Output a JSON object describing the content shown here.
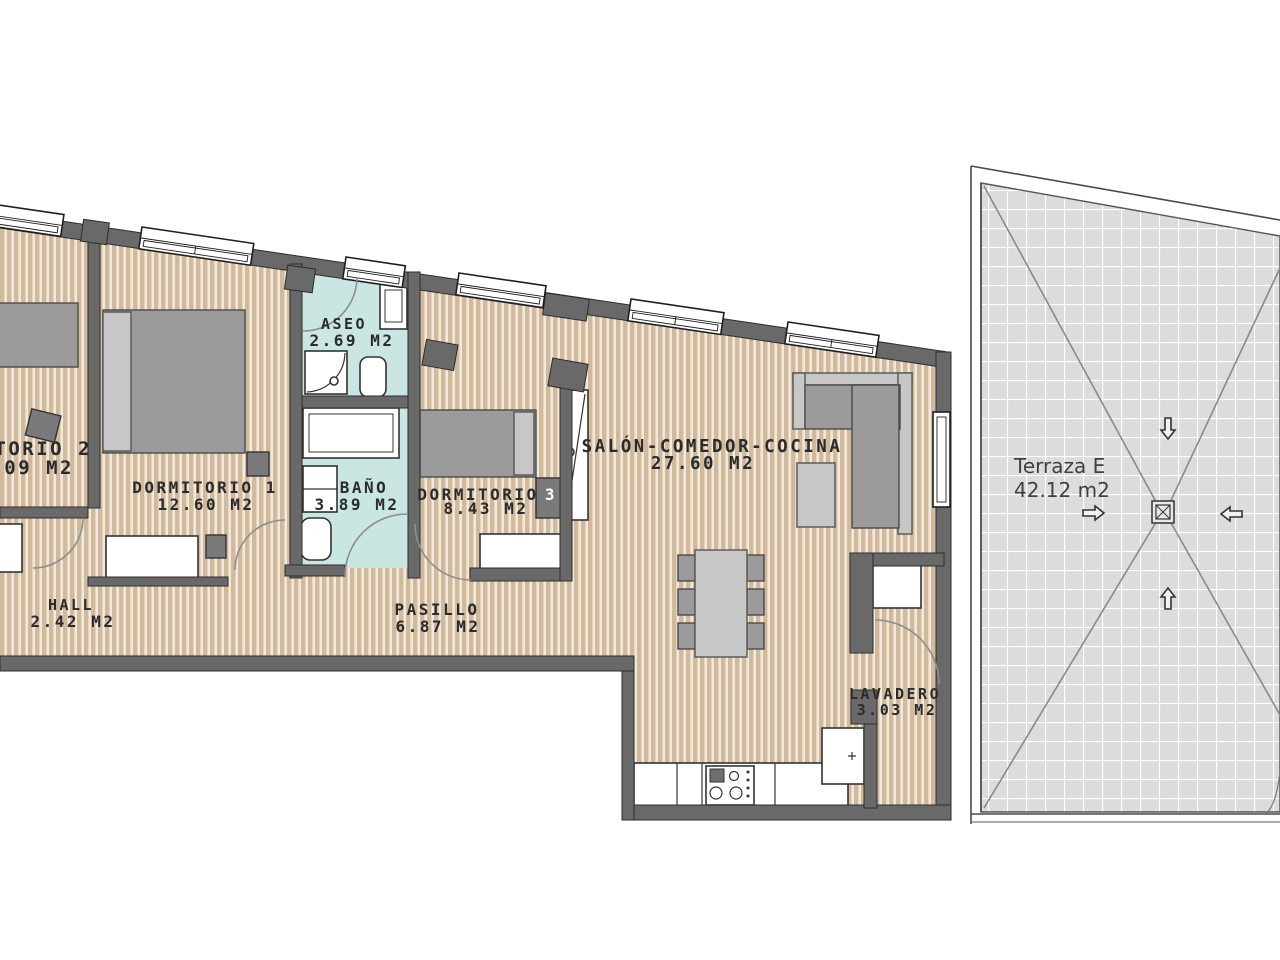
{
  "plan": {
    "rooms": {
      "dormitorio2": {
        "label": "ITORIO 2",
        "area": ".09 M2"
      },
      "dormitorio1": {
        "label": "DORMITORIO 1",
        "area": "12.60 M2"
      },
      "aseo": {
        "label": "ASEO",
        "area": "2.69 M2"
      },
      "bano": {
        "label": "BAÑO",
        "area": "3.89 M2"
      },
      "dormitorio3": {
        "label": "DORMITORIO",
        "number": "3",
        "area": "8.43 M2"
      },
      "salon": {
        "label": "SALÓN-COMEDOR-COCINA",
        "area": "27.60 M2"
      },
      "hall": {
        "label": "HALL",
        "area": "2.42 M2"
      },
      "pasillo": {
        "label": "PASILLO",
        "area": "6.87 M2"
      },
      "lavadero": {
        "label": "LAVADERO",
        "area": "3.03 M2"
      }
    },
    "terrace": {
      "label": "Terraza E",
      "area": "42.12 m2"
    },
    "icons": {
      "drain": "drain-grate-icon",
      "slope_arrows": "slope-direction-arrow-icons"
    },
    "colors": {
      "wood_floor": "#d1b99c",
      "wood_stripe": "#f1e9dc",
      "wet_floor": "#c9e6e2",
      "wall": "#696969",
      "terrace_tile": "#dcdcdc",
      "terrace_grid": "#ffffff",
      "furniture_gray": "#9b9b9b",
      "furniture_light": "#c7c7c7",
      "text": "#2b2b2b"
    }
  }
}
